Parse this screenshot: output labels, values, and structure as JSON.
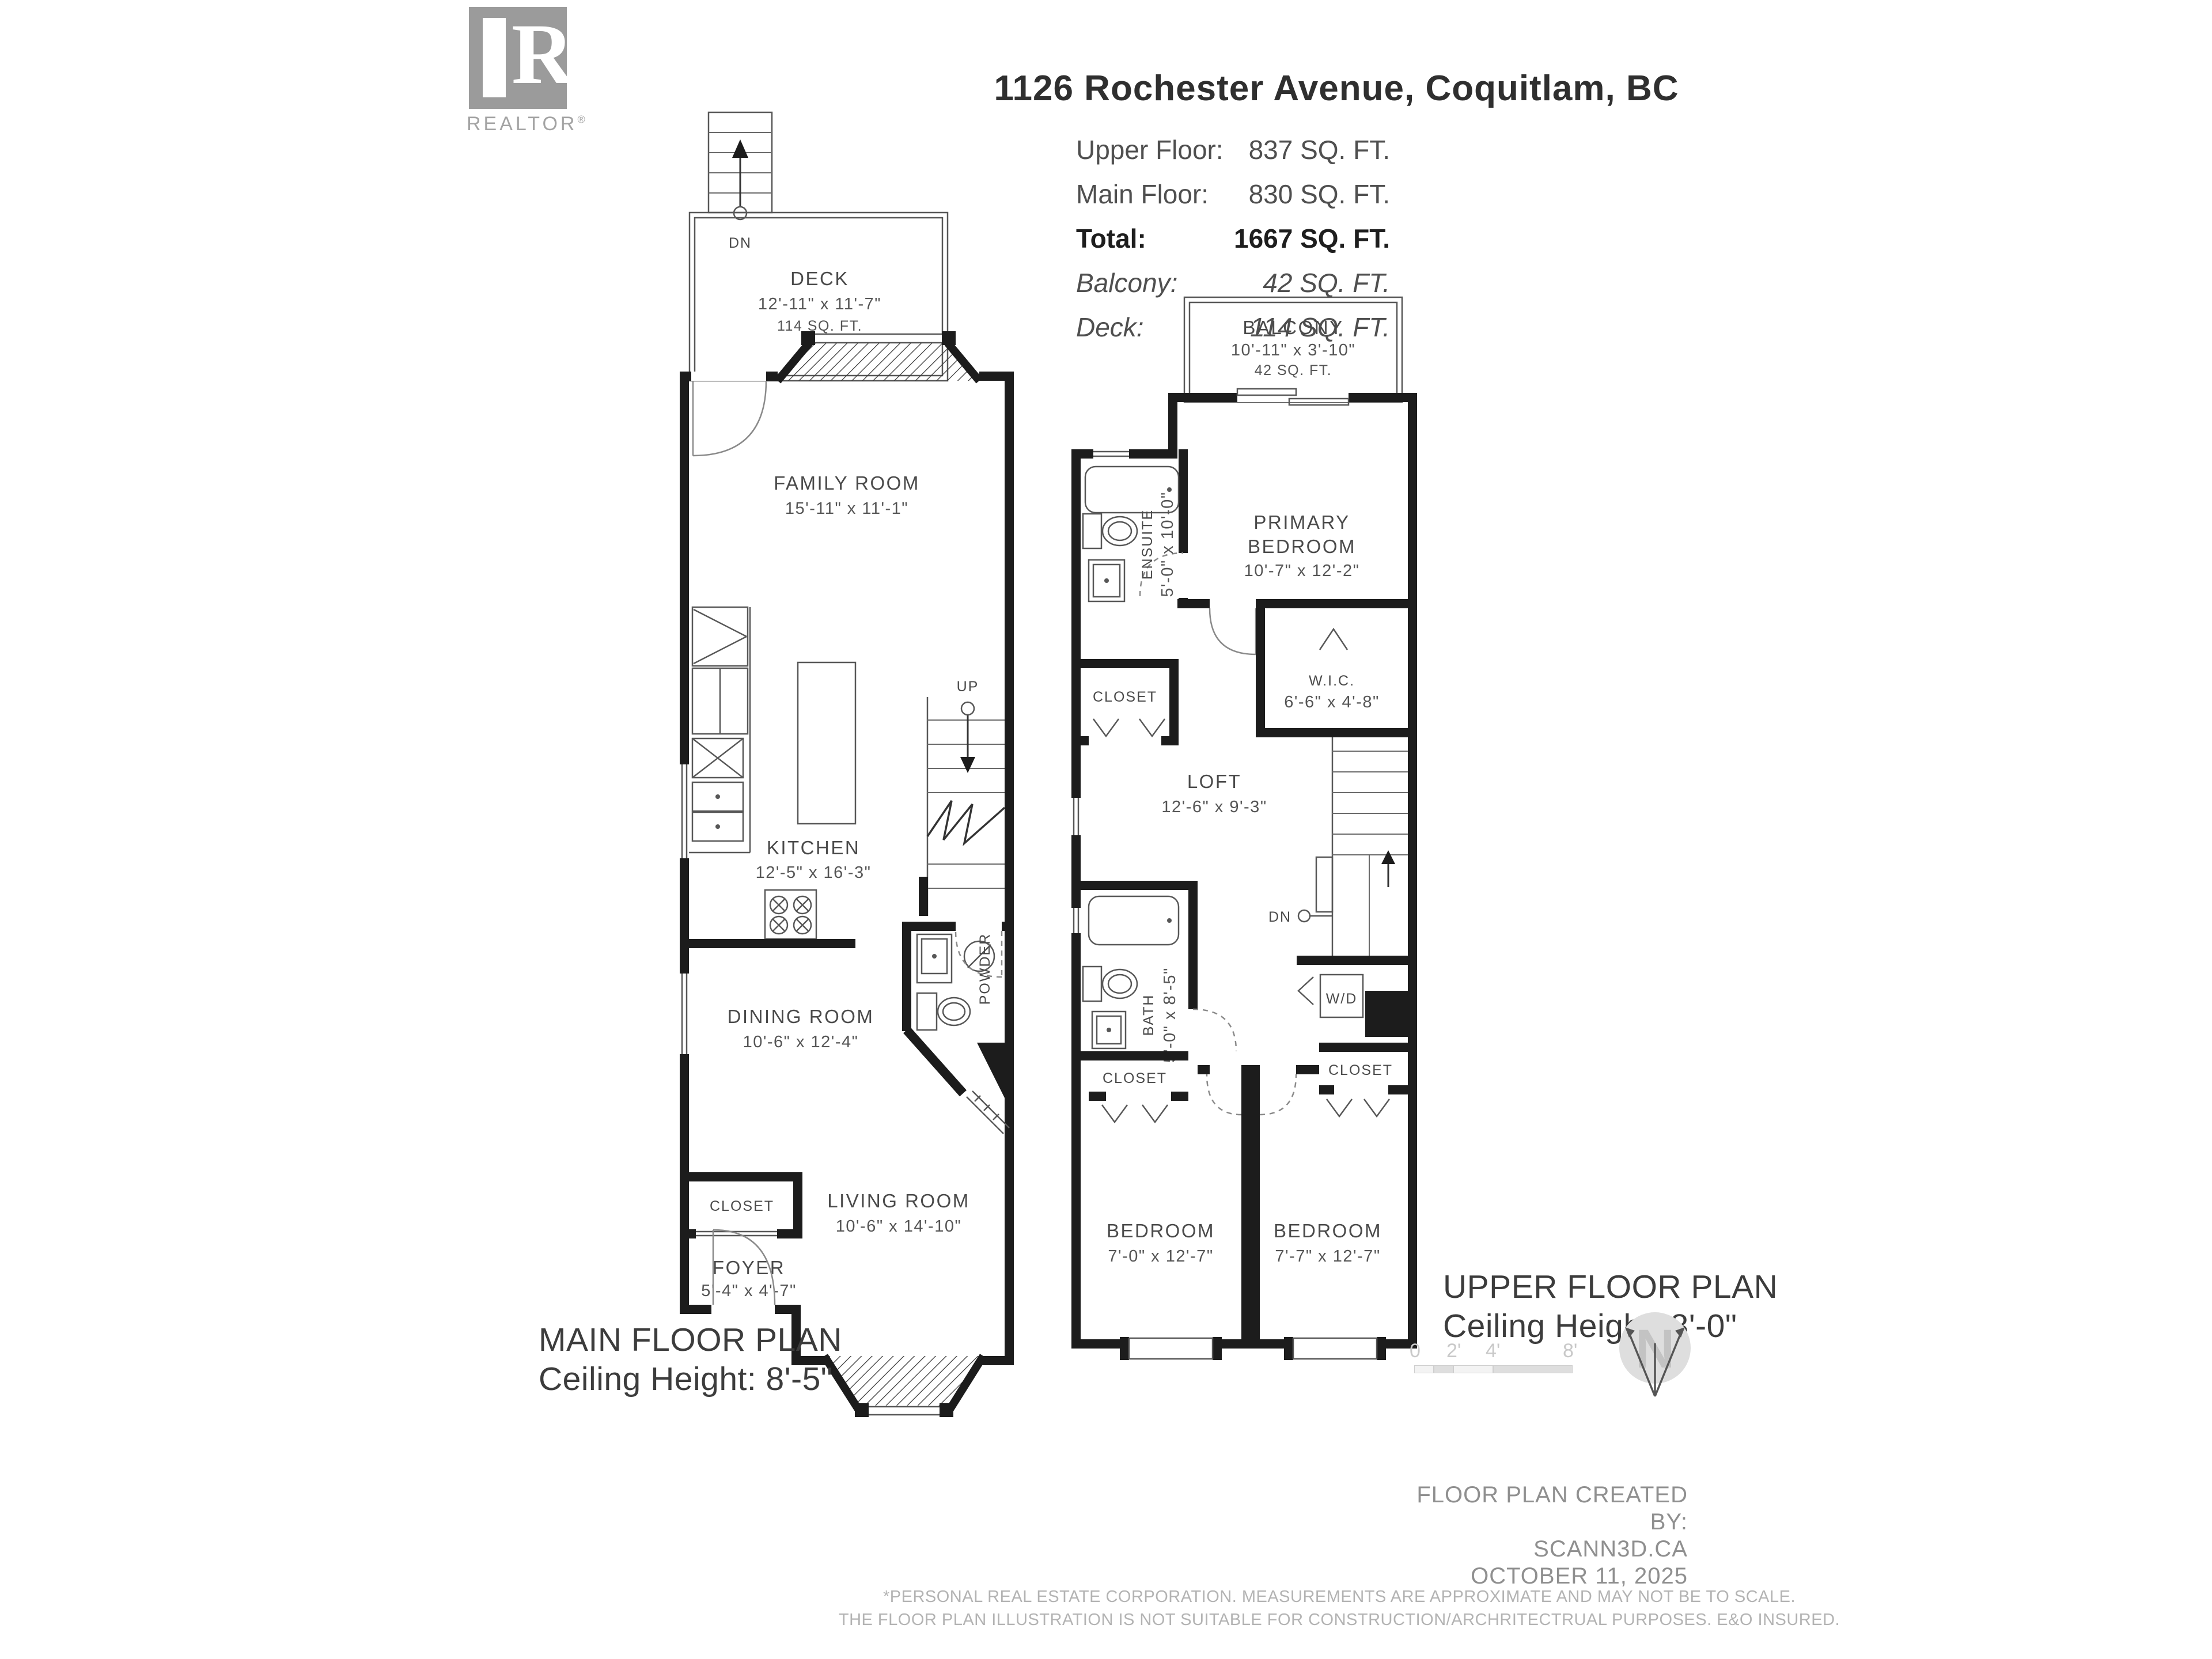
{
  "logo": {
    "letter": "R",
    "brand": "REALTOR",
    "registered": "®"
  },
  "header": {
    "title": "1126 Rochester Avenue, Coquitlam, BC"
  },
  "area_table": {
    "rows": [
      {
        "label": "Upper Floor:",
        "value": "837 SQ. FT.",
        "style": "regular"
      },
      {
        "label": "Main Floor:",
        "value": "830 SQ. FT.",
        "style": "regular"
      },
      {
        "label": "Total:",
        "value": "1667 SQ. FT.",
        "style": "bold"
      },
      {
        "label": "Balcony:",
        "value": "42 SQ. FT.",
        "style": "italic"
      },
      {
        "label": "Deck:",
        "value": "114 SQ. FT.",
        "style": "italic"
      }
    ]
  },
  "main_floor": {
    "plan_title": "MAIN FLOOR PLAN",
    "ceiling": "Ceiling Height: 8'-5\"",
    "deck": {
      "name": "DECK",
      "dims": "12'-11\" x 11'-7\"",
      "area": "114 SQ. FT."
    },
    "family_room": {
      "name": "FAMILY ROOM",
      "dims": "15'-11\" x 11'-1\""
    },
    "kitchen": {
      "name": "KITCHEN",
      "dims": "12'-5\" x 16'-3\""
    },
    "dining_room": {
      "name": "DINING ROOM",
      "dims": "10'-6\" x 12'-4\""
    },
    "living_room": {
      "name": "LIVING ROOM",
      "dims": "10'-6\" x 14'-10\""
    },
    "foyer": {
      "name": "FOYER",
      "dims": "5'-4\" x 4'-7\""
    },
    "closet": "CLOSET",
    "powder": "POWDER",
    "up": "UP",
    "dn": "DN"
  },
  "upper_floor": {
    "plan_title": "UPPER FLOOR PLAN",
    "ceiling": "Ceiling Height: 8'-0\"",
    "balcony": {
      "name": "BALCONY",
      "dims": "10'-11\" x 3'-10\"",
      "area": "42 SQ. FT."
    },
    "primary_bedroom": {
      "name_line1": "PRIMARY",
      "name_line2": "BEDROOM",
      "dims": "10'-7\" x 12'-2\""
    },
    "ensuite": {
      "name": "ENSUITE",
      "dims": "5'-0\" x 10'-0\""
    },
    "wic": {
      "name": "W.I.C.",
      "dims": "6'-6\" x 4'-8\""
    },
    "loft": {
      "name": "LOFT",
      "dims": "12'-6\" x 9'-3\""
    },
    "bath": {
      "name": "BATH",
      "dims": "5'-0\" x 8'-5\""
    },
    "bedroom_left": {
      "name": "BEDROOM",
      "dims": "7'-0\" x 12'-7\""
    },
    "bedroom_right": {
      "name": "BEDROOM",
      "dims": "7'-7\" x 12'-7\""
    },
    "closet": "CLOSET",
    "wd": "W/D",
    "dn": "DN"
  },
  "scale_bar": {
    "t0": "0",
    "t2": "2'",
    "t4": "4'",
    "t8": "8'"
  },
  "compass": {
    "letter": "N"
  },
  "footer": {
    "created_line1": "FLOOR PLAN CREATED BY:",
    "created_line2": "SCANN3D.CA",
    "created_line3": "OCTOBER 11, 2025",
    "disclaimer_line1": "*PERSONAL REAL ESTATE CORPORATION. MEASUREMENTS ARE APPROXIMATE AND MAY NOT BE TO SCALE.",
    "disclaimer_line2": "THE FLOOR PLAN ILLUSTRATION IS NOT SUITABLE FOR CONSTRUCTION/ARCHRITECTRUAL PURPOSES. E&O INSURED."
  }
}
